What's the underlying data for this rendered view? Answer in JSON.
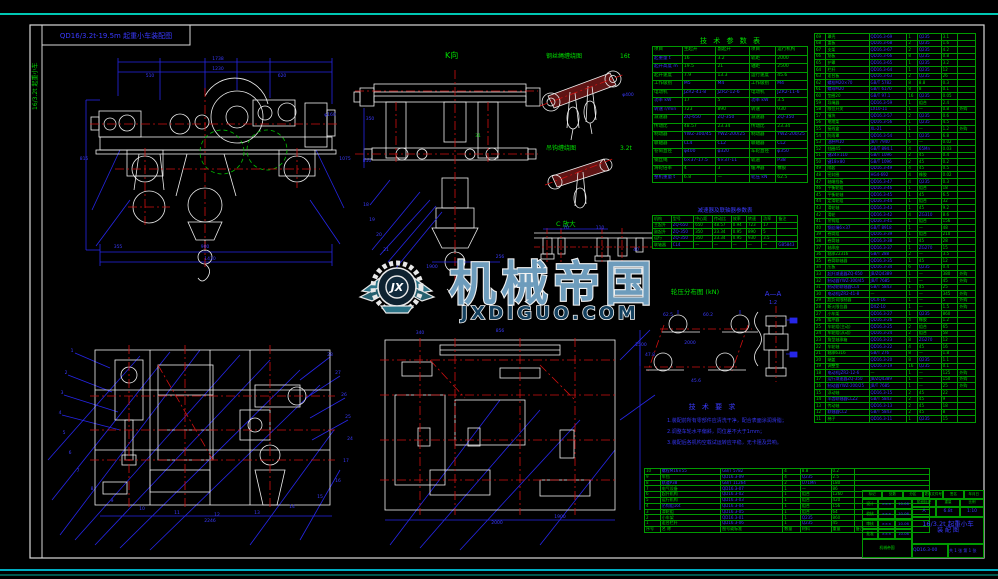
{
  "frame": {
    "corner_label": "QD16/3.2t-19.5m 起重小车装配图",
    "side_label": "16/3.2t 起重小车"
  },
  "watermark": {
    "logo_text": "JX",
    "title": "机械帝国",
    "domain": "JXDIGUO.COM"
  },
  "views": {
    "k_view": {
      "label": "K向"
    },
    "rope1": {
      "label": "钢丝绳缠绕图",
      "scale": "16t"
    },
    "rope2": {
      "label": "吊钩缠绕图",
      "scale": "3.2t"
    },
    "detail_c": {
      "label": "C 放大"
    },
    "wheel_load": {
      "label": "轮压分布图  (kN)"
    },
    "section_aa": {
      "label": "A—A",
      "scale": "1:2"
    }
  },
  "tech_requirements": {
    "title": "技 术 要 求",
    "lines": [
      "1.装配前所有零部件应清洗干净，配合表面涂润滑脂；",
      "2.调整车轮水平偏斜，同位差不大于1mm；",
      "3.装配后各机构空载试运转应平稳，无卡阻及异响。"
    ]
  },
  "param_table": {
    "title": "技 术 参 数 表",
    "header": [
      "项目",
      "主起升",
      "副起升",
      "项目",
      "运行机构"
    ],
    "rows": [
      [
        "起重量 t",
        "16",
        "3.2",
        "轨距",
        "2000"
      ],
      [
        "起升高度 m",
        "19.5",
        "21",
        "轴距",
        "2500"
      ],
      [
        "起升速度",
        "7.9",
        "13.3",
        "运行速度",
        "45.6"
      ],
      [
        "工作级别",
        "M5",
        "M4",
        "工作级别",
        "M4"
      ],
      [
        "电动机",
        "JZR2-41-8",
        "JZR2-12-6",
        "电动机",
        "JZR2-11-6"
      ],
      [
        "功率 kW",
        "17",
        "5",
        "功率 kW",
        "3.5"
      ],
      [
        "转速 r/min",
        "723",
        "890",
        "转速",
        "930"
      ],
      [
        "减速器",
        "ZQ-650",
        "ZQ-350",
        "减速器",
        "ZQ-350"
      ],
      [
        "传动比",
        "48.57",
        "23.34",
        "传动比",
        "23.34"
      ],
      [
        "制动器",
        "YWZ-300/45",
        "YWZ-200/25",
        "制动器",
        "YWZ-200/25"
      ],
      [
        "联轴器",
        "CL4",
        "CL2",
        "联轴器",
        "CL2"
      ],
      [
        "卷筒直径",
        "φ400",
        "φ320",
        "车轮直径",
        "φ350"
      ],
      [
        "钢丝绳",
        "6×37-17.5",
        "6×37-11",
        "轨道",
        "P38"
      ],
      [
        "滑轮倍率",
        "4",
        "3",
        "缓冲器",
        "橡胶"
      ],
      [
        "整机重量 t",
        "6.8",
        "—",
        "轮压 kN",
        "62.5"
      ]
    ]
  },
  "gear_table": {
    "title": "减速器及联轴器参数表",
    "header": [
      "机构",
      "型号",
      "中心距",
      "传动比",
      "效率",
      "转速",
      "功率",
      "备注"
    ],
    "rows": [
      [
        "主起升",
        "ZQ-650",
        "650",
        "48.57",
        "0.94",
        "723",
        "17",
        ""
      ],
      [
        "副起升",
        "ZQ-350",
        "350",
        "23.34",
        "0.95",
        "890",
        "5",
        ""
      ],
      [
        "运行",
        "ZQ-350",
        "350",
        "23.34",
        "0.95",
        "930",
        "3.5",
        ""
      ],
      [
        "联轴器",
        "CL4",
        "—",
        "—",
        "—",
        "—",
        "—",
        "GB5843"
      ]
    ]
  },
  "bom_right": {
    "rows": [
      [
        "69",
        "罩壳",
        "QD16.3-69",
        "1",
        "Q235",
        "3.1",
        ""
      ],
      [
        "68",
        "盖板",
        "QD16.3-68",
        "2",
        "Q235",
        "1.6",
        ""
      ],
      [
        "67",
        "支架",
        "QD16.3-67",
        "2",
        "Q235",
        "4.2",
        ""
      ],
      [
        "66",
        "筋板",
        "QD16.3-66",
        "8",
        "Q235",
        "0.8",
        ""
      ],
      [
        "65",
        "护罩",
        "QD16.3-65",
        "1",
        "Q235",
        "3.2",
        ""
      ],
      [
        "64",
        "栏杆",
        "QD16.3-64",
        "1",
        "Q235",
        "12",
        ""
      ],
      [
        "63",
        "走台板",
        "QD16.3-63",
        "2",
        "Q235",
        "26",
        ""
      ],
      [
        "62",
        "螺栓M20×70",
        "GB/T 5782",
        "8",
        "8.8",
        "0.3",
        ""
      ],
      [
        "61",
        "螺母M20",
        "GB/T 6170",
        "8",
        "8",
        "0.1",
        ""
      ],
      [
        "60",
        "垫圈20",
        "GB/T 97.1",
        "16",
        "Q235",
        "0.05",
        ""
      ],
      [
        "59",
        "导绳器",
        "QD16.3-59",
        "1",
        "组合",
        "2.4",
        ""
      ],
      [
        "58",
        "限位开关",
        "LX10-11",
        "1",
        "—",
        "0.8",
        "外购"
      ],
      [
        "57",
        "撞块",
        "QD16.3-57",
        "2",
        "Q235",
        "0.6",
        ""
      ],
      [
        "56",
        "电缆架",
        "QD16.3-56",
        "1",
        "Q235",
        "4.5",
        ""
      ],
      [
        "55",
        "接线盒",
        "XL-21",
        "1",
        "—",
        "1.2",
        "外购"
      ],
      [
        "54",
        "防雨罩",
        "QD16.3-54",
        "1",
        "Q235",
        "6.8",
        ""
      ],
      [
        "53",
        "油杯M10",
        "JB/T 7940",
        "6",
        "—",
        "0.02",
        ""
      ],
      [
        "52",
        "挡圈45",
        "GB/T 894.1",
        "4",
        "65Mn",
        "0.03",
        ""
      ],
      [
        "51",
        "键24×110",
        "GB/T 1096",
        "2",
        "45",
        "0.4",
        ""
      ],
      [
        "50",
        "键18×80",
        "GB/T 1096",
        "2",
        "45",
        "0.2",
        ""
      ],
      [
        "49",
        "隔套",
        "QD16.3-49",
        "4",
        "45",
        "0.5",
        ""
      ],
      [
        "48",
        "密封圈",
        "HG4-692",
        "4",
        "橡胶",
        "0.02",
        ""
      ],
      [
        "47",
        "轴端挡板",
        "QD16.3-47",
        "4",
        "Q235",
        "0.3",
        ""
      ],
      [
        "46",
        "平衡轮组",
        "QD16.3-46",
        "1",
        "组合",
        "18",
        ""
      ],
      [
        "45",
        "平衡轮轴",
        "QD16.3-45",
        "1",
        "45",
        "6.5",
        ""
      ],
      [
        "44",
        "定滑轮组",
        "QD16.3-44",
        "1",
        "组合",
        "32",
        ""
      ],
      [
        "43",
        "滑轮轴",
        "QD16.3-43",
        "1",
        "45",
        "9.2",
        ""
      ],
      [
        "42",
        "滑轮",
        "QD16.3-42",
        "4",
        "ZG310",
        "8.6",
        ""
      ],
      [
        "41",
        "吊钩组",
        "QD16.3-41",
        "1",
        "组合",
        "156",
        ""
      ],
      [
        "40",
        "钢丝绳6×37",
        "GB/T 8918",
        "1",
        "—",
        "48",
        ""
      ],
      [
        "39",
        "卷筒组",
        "QD16.3-39",
        "1",
        "组合",
        "210",
        ""
      ],
      [
        "38",
        "卷筒轴",
        "QD16.3-38",
        "1",
        "45",
        "28",
        ""
      ],
      [
        "37",
        "轴承座",
        "QD16.3-37",
        "1",
        "ZG270",
        "15",
        ""
      ],
      [
        "36",
        "轴承22316",
        "GB/T 288",
        "2",
        "—",
        "3.5",
        ""
      ],
      [
        "35",
        "卷筒联轴器",
        "QD16.3-35",
        "1",
        "45",
        "12",
        ""
      ],
      [
        "34",
        "压板",
        "QD16.3-34",
        "6",
        "Q235",
        "0.4",
        ""
      ],
      [
        "33",
        "起升减速器ZQ-650",
        "JB/ZQ4389",
        "1",
        "—",
        "380",
        "外购"
      ],
      [
        "32",
        "制动器YWZ-300/45",
        "JB/T 7685",
        "1",
        "—",
        "45",
        "外购"
      ],
      [
        "31",
        "制动轮联轴器CL4",
        "GB/T 5843",
        "1",
        "45",
        "25",
        ""
      ],
      [
        "30",
        "电动机JZR2-41-8",
        "—",
        "1",
        "—",
        "345",
        "外购"
      ],
      [
        "29",
        "超负荷限制器",
        "QCX-16",
        "1",
        "—",
        "5",
        "外购"
      ],
      [
        "28",
        "断火限位器",
        "DXZ-10",
        "1",
        "—",
        "1.5",
        "外购"
      ],
      [
        "27",
        "小车架",
        "QD16.3-27",
        "1",
        "Q235",
        "860",
        ""
      ],
      [
        "26",
        "缓冲器",
        "QD16.3-26",
        "4",
        "橡胶",
        "1.2",
        ""
      ],
      [
        "25",
        "车轮组(主动)",
        "QD16.3-25",
        "2",
        "组合",
        "65",
        ""
      ],
      [
        "24",
        "车轮组(从动)",
        "QD16.3-24",
        "2",
        "组合",
        "58",
        ""
      ],
      [
        "23",
        "角型轴承箱",
        "QD16.3-23",
        "8",
        "ZG270",
        "12",
        ""
      ],
      [
        "22",
        "车轮轴",
        "QD16.3-22",
        "4",
        "45",
        "16",
        ""
      ],
      [
        "21",
        "轴承6316",
        "GB/T 276",
        "8",
        "—",
        "1.8",
        ""
      ],
      [
        "20",
        "端盖",
        "QD16.3-20",
        "8",
        "Q235",
        "1.1",
        ""
      ],
      [
        "19",
        "调整垫",
        "QD16.3-19",
        "16",
        "Q235",
        "0.1",
        ""
      ],
      [
        "18",
        "电动机JZR2-12-6",
        "—",
        "1",
        "—",
        "125",
        "外购"
      ],
      [
        "17",
        "运行减速器ZQ-350",
        "JB/ZQ4389",
        "1",
        "—",
        "150",
        "外购"
      ],
      [
        "16",
        "制动器YWZ-200/25",
        "JB/T 7685",
        "1",
        "—",
        "25",
        "外购"
      ],
      [
        "15",
        "浮动轴",
        "QD16.3-15",
        "2",
        "45",
        "22",
        ""
      ],
      [
        "14",
        "半齿联轴器CLZ2",
        "GB/T 5843",
        "2",
        "45",
        "9",
        ""
      ],
      [
        "13",
        "传动轴",
        "QD16.3-13",
        "2",
        "45",
        "18",
        ""
      ],
      [
        "12",
        "联轴器CL2",
        "GB/T 5843",
        "2",
        "45",
        "8",
        ""
      ],
      [
        "11",
        "梯子",
        "QD16.3-11",
        "1",
        "Q235",
        "15",
        ""
      ]
    ]
  },
  "bom_bottom": {
    "rows": [
      [
        "10",
        "螺栓M16×55",
        "GB/T 5782",
        "4",
        "8.8",
        "0.2",
        ""
      ],
      [
        "9",
        "车挡",
        "QD16.3-09",
        "4",
        "Q235",
        "2.5",
        ""
      ],
      [
        "8",
        "轨道P38",
        "GB/T 11264",
        "2",
        "U71Mn",
        "180",
        ""
      ],
      [
        "7",
        "电气设备",
        "QD16.3-07",
        "1",
        "—",
        "86",
        ""
      ],
      [
        "6",
        "起升机构",
        "QD16.3-02",
        "1",
        "组合",
        "1260",
        ""
      ],
      [
        "5",
        "运行机构",
        "QD16.3-03",
        "1",
        "组合",
        "420",
        ""
      ],
      [
        "4",
        "吊钩组16t",
        "QD16.3-04",
        "1",
        "组合",
        "156",
        ""
      ],
      [
        "3",
        "滑轮组",
        "QD16.3-05",
        "1",
        "组合",
        "64",
        ""
      ],
      [
        "2",
        "小车架",
        "QD16.3-01",
        "1",
        "Q235",
        "860",
        ""
      ],
      [
        "1",
        "走台栏杆",
        "QD16.3-06",
        "1",
        "Q235",
        "45",
        ""
      ]
    ],
    "header": [
      "序号",
      "名  称",
      "图号或标准",
      "数量",
      "材料",
      "重量",
      "备注"
    ]
  },
  "title_block": {
    "top_row": [
      "标记",
      "处数",
      "分区",
      "更改文件号",
      "签名",
      "年月日"
    ],
    "sign_rows": [
      [
        "设计",
        "×××",
        "10.06"
      ],
      [
        "校核",
        "×××",
        "10.06"
      ],
      [
        "审核",
        "×××",
        "10.06"
      ],
      [
        "批准",
        "×××",
        "10.06"
      ]
    ],
    "stage_header": [
      "阶段标记",
      "重量",
      "比例"
    ],
    "stage_values": [
      "A",
      "6.8t",
      "1:10"
    ],
    "title_line1": "16/3.2t 起重小车",
    "title_line2": "装 配 图",
    "drawing_no": "QD16.3-00",
    "sheet": "共 1 张  第 1 张"
  },
  "dims": [
    {
      "x": 218,
      "y": 60,
      "t": "1738",
      "c": "b"
    },
    {
      "x": 218,
      "y": 70,
      "t": "1230",
      "c": "b"
    },
    {
      "x": 150,
      "y": 77,
      "t": "510",
      "c": "b"
    },
    {
      "x": 282,
      "y": 77,
      "t": "620",
      "c": "b"
    },
    {
      "x": 84,
      "y": 160,
      "t": "815",
      "c": "b"
    },
    {
      "x": 330,
      "y": 116,
      "t": "φ160",
      "c": "b"
    },
    {
      "x": 205,
      "y": 248,
      "t": "900",
      "c": "b"
    },
    {
      "x": 210,
      "y": 260,
      "t": "1430",
      "c": "b"
    },
    {
      "x": 118,
      "y": 248,
      "t": "355",
      "c": "b"
    },
    {
      "x": 345,
      "y": 160,
      "t": "1075",
      "c": "b"
    },
    {
      "x": 370,
      "y": 120,
      "t": "350",
      "c": "b"
    },
    {
      "x": 367,
      "y": 162,
      "t": "810",
      "c": "b"
    },
    {
      "x": 478,
      "y": 137,
      "t": "31",
      "c": "g"
    },
    {
      "x": 500,
      "y": 258,
      "t": "256",
      "c": "b"
    },
    {
      "x": 432,
      "y": 268,
      "t": "1900",
      "c": "b"
    },
    {
      "x": 366,
      "y": 206,
      "t": "18",
      "c": "b"
    },
    {
      "x": 372,
      "y": 221,
      "t": "19",
      "c": "b"
    },
    {
      "x": 379,
      "y": 236,
      "t": "20",
      "c": "b"
    },
    {
      "x": 386,
      "y": 251,
      "t": "21",
      "c": "b"
    },
    {
      "x": 628,
      "y": 96,
      "t": "φ400",
      "c": "b"
    },
    {
      "x": 566,
      "y": 229,
      "t": "70",
      "c": "b"
    },
    {
      "x": 600,
      "y": 229,
      "t": "110",
      "c": "b"
    },
    {
      "x": 636,
      "y": 251,
      "t": "40",
      "c": "b"
    },
    {
      "x": 668,
      "y": 316,
      "t": "62.5",
      "c": "b"
    },
    {
      "x": 708,
      "y": 316,
      "t": "60.2",
      "c": "b"
    },
    {
      "x": 650,
      "y": 356,
      "t": "47.8",
      "c": "b"
    },
    {
      "x": 696,
      "y": 382,
      "t": "45.6",
      "c": "b"
    },
    {
      "x": 690,
      "y": 344,
      "t": "2000",
      "c": "b"
    },
    {
      "x": 641,
      "y": 346,
      "t": "2500",
      "c": "b"
    },
    {
      "x": 210,
      "y": 522,
      "t": "2246",
      "c": "b"
    },
    {
      "x": 497,
      "y": 524,
      "t": "2000",
      "c": "b"
    },
    {
      "x": 500,
      "y": 332,
      "t": "856",
      "c": "b"
    },
    {
      "x": 420,
      "y": 334,
      "t": "340",
      "c": "b"
    },
    {
      "x": 560,
      "y": 518,
      "t": "1900",
      "c": "b"
    },
    {
      "x": 72,
      "y": 352,
      "t": "1",
      "c": "b"
    },
    {
      "x": 66,
      "y": 374,
      "t": "2",
      "c": "b"
    },
    {
      "x": 62,
      "y": 394,
      "t": "3",
      "c": "b"
    },
    {
      "x": 60,
      "y": 414,
      "t": "4",
      "c": "b"
    },
    {
      "x": 64,
      "y": 434,
      "t": "5",
      "c": "b"
    },
    {
      "x": 70,
      "y": 454,
      "t": "6",
      "c": "b"
    },
    {
      "x": 78,
      "y": 472,
      "t": "7",
      "c": "b"
    },
    {
      "x": 92,
      "y": 490,
      "t": "8",
      "c": "b"
    },
    {
      "x": 112,
      "y": 502,
      "t": "9",
      "c": "b"
    },
    {
      "x": 142,
      "y": 510,
      "t": "10",
      "c": "b"
    },
    {
      "x": 177,
      "y": 514,
      "t": "11",
      "c": "b"
    },
    {
      "x": 217,
      "y": 516,
      "t": "12",
      "c": "b"
    },
    {
      "x": 257,
      "y": 514,
      "t": "13",
      "c": "b"
    },
    {
      "x": 292,
      "y": 508,
      "t": "14",
      "c": "b"
    },
    {
      "x": 320,
      "y": 498,
      "t": "15",
      "c": "b"
    },
    {
      "x": 338,
      "y": 482,
      "t": "16",
      "c": "b"
    },
    {
      "x": 346,
      "y": 462,
      "t": "17",
      "c": "b"
    },
    {
      "x": 350,
      "y": 440,
      "t": "24",
      "c": "b"
    },
    {
      "x": 348,
      "y": 418,
      "t": "25",
      "c": "b"
    },
    {
      "x": 344,
      "y": 396,
      "t": "26",
      "c": "b"
    },
    {
      "x": 338,
      "y": 374,
      "t": "27",
      "c": "b"
    },
    {
      "x": 330,
      "y": 356,
      "t": "28",
      "c": "b"
    }
  ]
}
